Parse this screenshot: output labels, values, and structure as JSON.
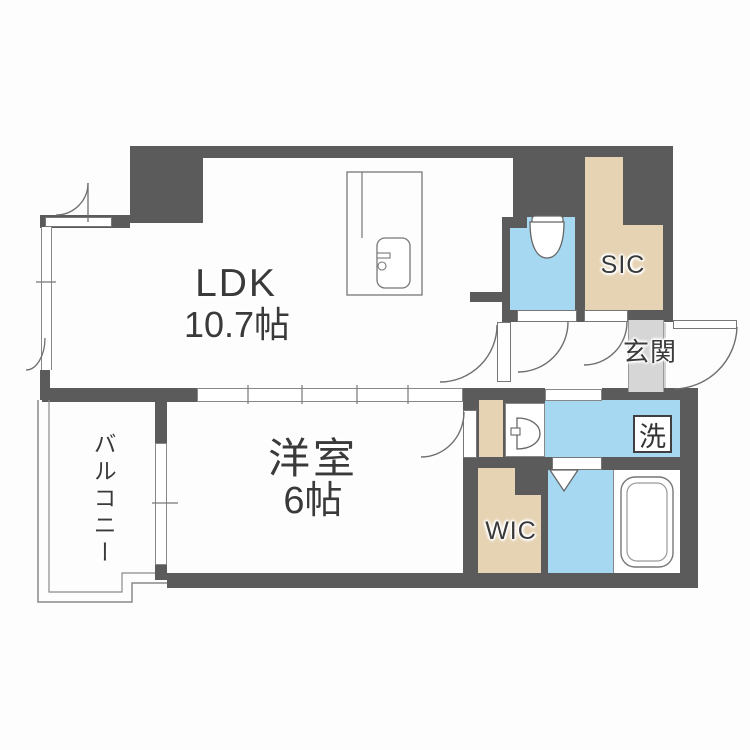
{
  "floorplan": {
    "rooms": {
      "ldk": {
        "label": "LDK",
        "size": "10.7帖"
      },
      "bedroom": {
        "label": "洋室",
        "size": "6帖"
      },
      "balcony": {
        "label": "バルコニー"
      },
      "entrance": {
        "label": "玄関"
      },
      "sic": {
        "label": "SIC"
      },
      "wic": {
        "label": "WIC"
      },
      "laundry": {
        "label": "洗"
      }
    },
    "colors": {
      "wall": "#5b5b5b",
      "wet_area_blue": "#a6d8f2",
      "storage_beige": "#e6d3b4",
      "entrance_floor_gray": "#d6d6d6",
      "floor": "#fdfdfd",
      "line": "#808080",
      "text": "#3a3a3a"
    }
  }
}
